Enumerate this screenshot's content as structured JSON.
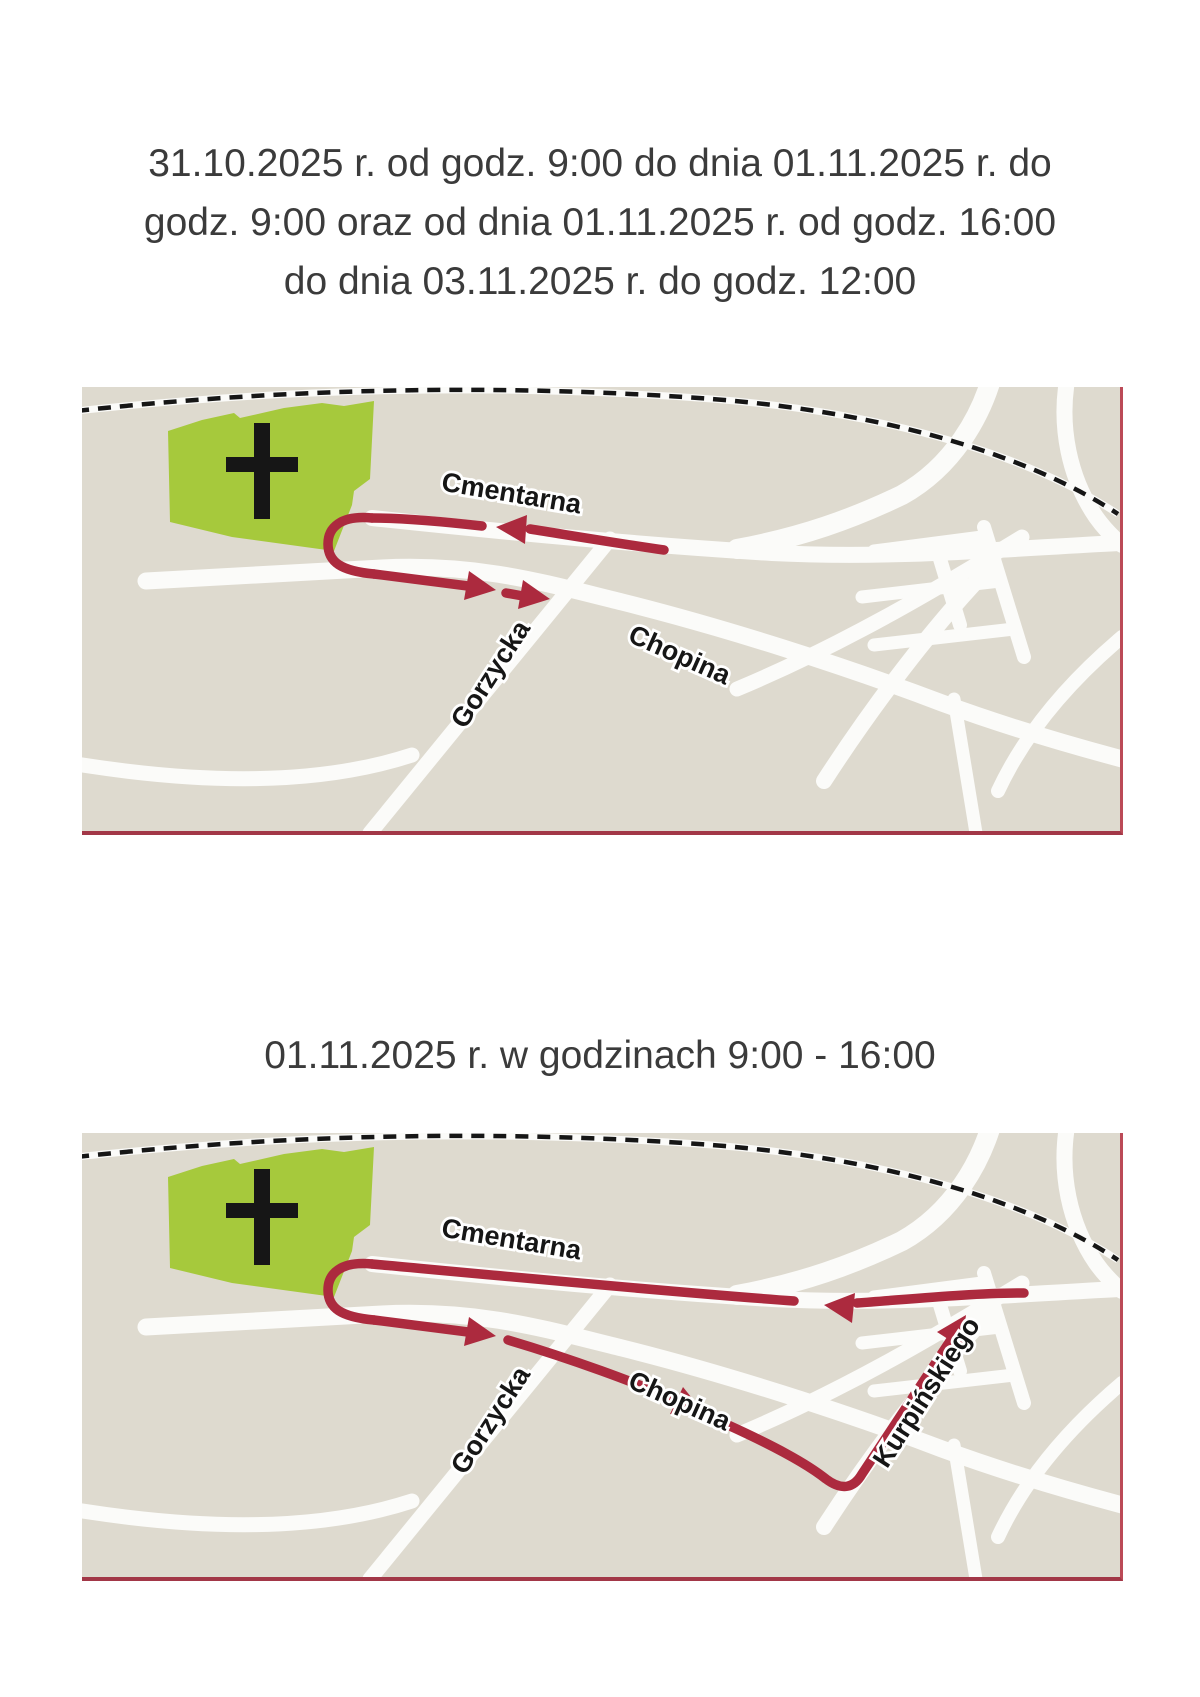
{
  "colors": {
    "page-bg": "#ffffff",
    "text": "#3b3b3b",
    "map-bg": "#dedacf",
    "road": "#fbfbf9",
    "rail": "#161616",
    "green": "#a6c93c",
    "label": "#161616",
    "halo": "#ffffff",
    "route": "#ac2a3e",
    "border-right": "#bb4a57",
    "border-bottom": "#a23747"
  },
  "headers": {
    "period1_lines": [
      "31.10.2025 r. od godz. 9:00 do dnia 01.11.2025 r. do",
      "godz. 9:00 oraz od dnia 01.11.2025 r. od godz. 16:00",
      "do dnia 03.11.2025 r. do godz. 12:00"
    ],
    "period2": "01.11.2025 r. w godzinach 9:00 - 16:00"
  },
  "map1": {
    "labels": {
      "cmentarna": "Cmentarna",
      "gorzycka": "Gorzycka",
      "chopina": "Chopina"
    }
  },
  "map2": {
    "labels": {
      "cmentarna": "Cmentarna",
      "gorzycka": "Gorzycka",
      "chopina": "Chopina",
      "kurpinskiego": "Kurpińskiego"
    }
  }
}
